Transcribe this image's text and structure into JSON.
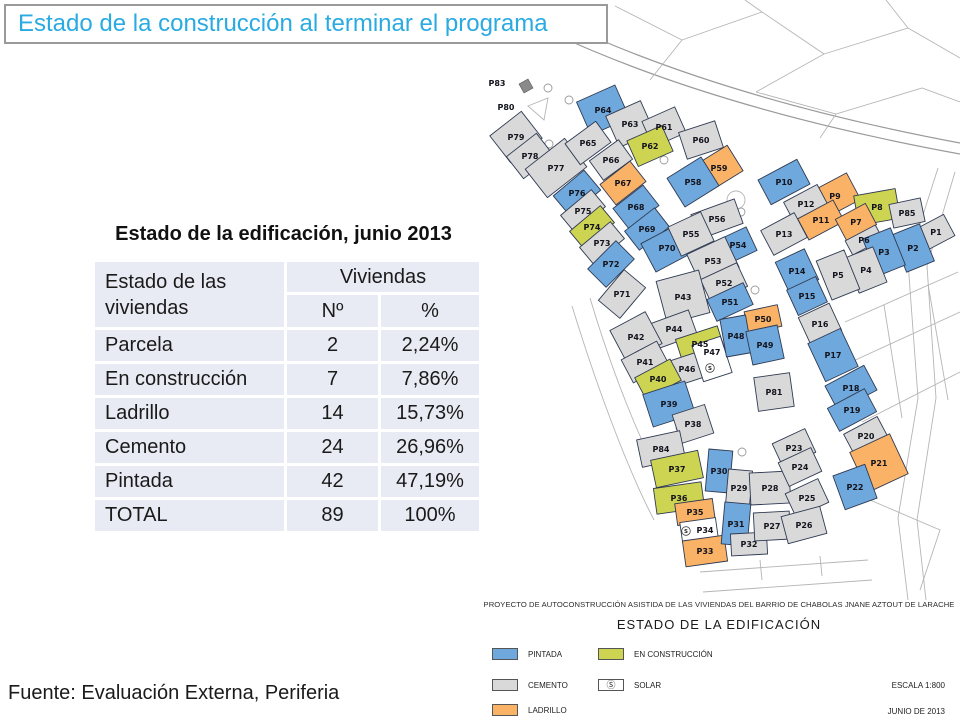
{
  "title": {
    "text": "Estado de la construcción al terminar el programa",
    "color": "#29ABE2"
  },
  "table": {
    "title": "Estado de la edificación, junio 2013",
    "row_header": "Estado de las viviendas",
    "col_group": "Viviendas",
    "columns": [
      "Nº",
      "%"
    ],
    "rows": [
      {
        "label": "Parcela",
        "n": "2",
        "pct": "2,24%"
      },
      {
        "label": "En construcción",
        "n": "7",
        "pct": "7,86%"
      },
      {
        "label": "Ladrillo",
        "n": "14",
        "pct": "15,73%"
      },
      {
        "label": "Cemento",
        "n": "24",
        "pct": "26,96%"
      },
      {
        "label": "Pintada",
        "n": "42",
        "pct": "47,19%"
      },
      {
        "label": "TOTAL",
        "n": "89",
        "pct": "100%"
      }
    ]
  },
  "map": {
    "caption_line1": "PROYECTO DE AUTOCONSTRUCCIÓN ASISTIDA DE LAS VIVIENDAS DEL BARRIO DE CHABOLAS JNANE AZTOUT DE LARACHE",
    "caption_line2": "ESTADO DE LA EDIFICACIÓN",
    "scale": "ESCALA 1:800",
    "date": "JUNIO DE 2013",
    "solar_symbol": "S",
    "status_colors": {
      "pintada": "#6FA8DC",
      "cemento": "#D9D9D9",
      "ladrillo": "#F9B266",
      "construccion": "#CDD452",
      "solar": "#FFFFFF"
    },
    "legend": [
      {
        "label": "PINTADA",
        "status": "pintada"
      },
      {
        "label": "CEMENTO",
        "status": "cemento"
      },
      {
        "label": "LADRILLO",
        "status": "ladrillo"
      },
      {
        "label": "EN CONSTRUCCIÓN",
        "status": "construccion"
      },
      {
        "label": "SOLAR",
        "status": "solar"
      }
    ],
    "floating_labels": [
      {
        "text": "P83",
        "x": 497,
        "y": 86
      },
      {
        "text": "P80",
        "x": 506,
        "y": 110
      }
    ],
    "solar_marks": [
      {
        "x": 710,
        "y": 368
      },
      {
        "x": 686,
        "y": 531
      }
    ],
    "parcels": [
      {
        "id": "P79",
        "s": "cemento",
        "x": 516,
        "y": 137,
        "w": 40,
        "h": 34,
        "a": -38
      },
      {
        "id": "P78",
        "s": "cemento",
        "x": 530,
        "y": 156,
        "w": 38,
        "h": 28,
        "a": -38
      },
      {
        "id": "P77",
        "s": "cemento",
        "x": 556,
        "y": 168,
        "w": 50,
        "h": 36,
        "a": -38
      },
      {
        "id": "P76",
        "s": "pintada",
        "x": 577,
        "y": 193,
        "w": 40,
        "h": 26,
        "a": -40
      },
      {
        "id": "P75",
        "s": "cemento",
        "x": 583,
        "y": 211,
        "w": 40,
        "h": 22,
        "a": -40
      },
      {
        "id": "P74",
        "s": "construccion",
        "x": 592,
        "y": 227,
        "w": 40,
        "h": 22,
        "a": -40
      },
      {
        "id": "P73",
        "s": "cemento",
        "x": 602,
        "y": 243,
        "w": 40,
        "h": 22,
        "a": -40
      },
      {
        "id": "P72",
        "s": "pintada",
        "x": 611,
        "y": 264,
        "w": 40,
        "h": 26,
        "a": -45
      },
      {
        "id": "P71",
        "s": "cemento",
        "x": 622,
        "y": 294,
        "w": 40,
        "h": 28,
        "a": -50
      },
      {
        "id": "P64",
        "s": "pintada",
        "x": 603,
        "y": 110,
        "w": 42,
        "h": 36,
        "a": -24
      },
      {
        "id": "P63",
        "s": "cemento",
        "x": 630,
        "y": 124,
        "w": 38,
        "h": 34,
        "a": -24
      },
      {
        "id": "P61",
        "s": "cemento",
        "x": 664,
        "y": 127,
        "w": 36,
        "h": 28,
        "a": -24
      },
      {
        "id": "P62",
        "s": "construccion",
        "x": 650,
        "y": 146,
        "w": 38,
        "h": 28,
        "a": -24
      },
      {
        "id": "P65",
        "s": "cemento",
        "x": 588,
        "y": 143,
        "w": 38,
        "h": 26,
        "a": -36
      },
      {
        "id": "P66",
        "s": "cemento",
        "x": 611,
        "y": 160,
        "w": 36,
        "h": 24,
        "a": -36
      },
      {
        "id": "P67",
        "s": "ladrillo",
        "x": 623,
        "y": 183,
        "w": 38,
        "h": 26,
        "a": -38
      },
      {
        "id": "P68",
        "s": "pintada",
        "x": 636,
        "y": 207,
        "w": 38,
        "h": 26,
        "a": -38
      },
      {
        "id": "P69",
        "s": "pintada",
        "x": 647,
        "y": 229,
        "w": 38,
        "h": 24,
        "a": -38
      },
      {
        "id": "P70",
        "s": "pintada",
        "x": 667,
        "y": 248,
        "w": 42,
        "h": 32,
        "a": -28
      },
      {
        "id": "P60",
        "s": "cemento",
        "x": 701,
        "y": 140,
        "w": 38,
        "h": 28,
        "a": -18
      },
      {
        "id": "P59",
        "s": "ladrillo",
        "x": 719,
        "y": 168,
        "w": 38,
        "h": 30,
        "a": -32
      },
      {
        "id": "P58",
        "s": "pintada",
        "x": 693,
        "y": 182,
        "w": 40,
        "h": 34,
        "a": -32
      },
      {
        "id": "P10",
        "s": "pintada",
        "x": 784,
        "y": 182,
        "w": 44,
        "h": 28,
        "a": -28
      },
      {
        "id": "P9",
        "s": "ladrillo",
        "x": 835,
        "y": 196,
        "w": 42,
        "h": 30,
        "a": -28
      },
      {
        "id": "P12",
        "s": "cemento",
        "x": 806,
        "y": 204,
        "w": 38,
        "h": 24,
        "a": -28
      },
      {
        "id": "P11",
        "s": "ladrillo",
        "x": 821,
        "y": 220,
        "w": 40,
        "h": 24,
        "a": -28
      },
      {
        "id": "P8",
        "s": "construccion",
        "x": 877,
        "y": 207,
        "w": 42,
        "h": 30,
        "a": -10
      },
      {
        "id": "P85",
        "s": "cemento",
        "x": 907,
        "y": 213,
        "w": 32,
        "h": 24,
        "a": -12
      },
      {
        "id": "P7",
        "s": "ladrillo",
        "x": 856,
        "y": 222,
        "w": 34,
        "h": 24,
        "a": -28
      },
      {
        "id": "P6",
        "s": "cemento",
        "x": 864,
        "y": 240,
        "w": 34,
        "h": 16,
        "a": -28
      },
      {
        "id": "P13",
        "s": "cemento",
        "x": 784,
        "y": 234,
        "w": 38,
        "h": 28,
        "a": -28
      },
      {
        "id": "P1",
        "s": "cemento",
        "x": 936,
        "y": 232,
        "w": 30,
        "h": 24,
        "a": -28
      },
      {
        "id": "P2",
        "s": "pintada",
        "x": 913,
        "y": 248,
        "w": 30,
        "h": 40,
        "a": -22
      },
      {
        "id": "P3",
        "s": "pintada",
        "x": 884,
        "y": 252,
        "w": 30,
        "h": 40,
        "a": -22
      },
      {
        "id": "P4",
        "s": "cemento",
        "x": 866,
        "y": 270,
        "w": 30,
        "h": 38,
        "a": -22
      },
      {
        "id": "P5",
        "s": "cemento",
        "x": 838,
        "y": 275,
        "w": 30,
        "h": 42,
        "a": -22
      },
      {
        "id": "P56",
        "s": "cemento",
        "x": 717,
        "y": 219,
        "w": 46,
        "h": 26,
        "a": -20
      },
      {
        "id": "P55",
        "s": "cemento",
        "x": 691,
        "y": 234,
        "w": 36,
        "h": 32,
        "a": -25
      },
      {
        "id": "P54",
        "s": "pintada",
        "x": 738,
        "y": 245,
        "w": 30,
        "h": 26,
        "a": -25
      },
      {
        "id": "P53",
        "s": "cemento",
        "x": 713,
        "y": 261,
        "w": 42,
        "h": 34,
        "a": -25
      },
      {
        "id": "P52",
        "s": "cemento",
        "x": 724,
        "y": 283,
        "w": 40,
        "h": 26,
        "a": -25
      },
      {
        "id": "P51",
        "s": "pintada",
        "x": 730,
        "y": 302,
        "w": 40,
        "h": 24,
        "a": -25
      },
      {
        "id": "P14",
        "s": "pintada",
        "x": 797,
        "y": 271,
        "w": 32,
        "h": 34,
        "a": -25
      },
      {
        "id": "P15",
        "s": "pintada",
        "x": 807,
        "y": 296,
        "w": 32,
        "h": 28,
        "a": -25
      },
      {
        "id": "P16",
        "s": "cemento",
        "x": 820,
        "y": 324,
        "w": 34,
        "h": 30,
        "a": -25
      },
      {
        "id": "P17",
        "s": "pintada",
        "x": 833,
        "y": 355,
        "w": 36,
        "h": 42,
        "a": -25
      },
      {
        "id": "P18",
        "s": "pintada",
        "x": 851,
        "y": 388,
        "w": 44,
        "h": 28,
        "a": -28
      },
      {
        "id": "P19",
        "s": "pintada",
        "x": 852,
        "y": 410,
        "w": 42,
        "h": 26,
        "a": -28
      },
      {
        "id": "P20",
        "s": "cemento",
        "x": 866,
        "y": 436,
        "w": 38,
        "h": 24,
        "a": -28
      },
      {
        "id": "P21",
        "s": "ladrillo",
        "x": 879,
        "y": 463,
        "w": 44,
        "h": 44,
        "a": -25
      },
      {
        "id": "P22",
        "s": "pintada",
        "x": 855,
        "y": 487,
        "w": 34,
        "h": 36,
        "a": -20
      },
      {
        "id": "P43",
        "s": "cemento",
        "x": 683,
        "y": 297,
        "w": 44,
        "h": 44,
        "a": -15
      },
      {
        "id": "P44",
        "s": "cemento",
        "x": 674,
        "y": 329,
        "w": 40,
        "h": 26,
        "a": -20
      },
      {
        "id": "P45",
        "s": "construccion",
        "x": 700,
        "y": 344,
        "w": 44,
        "h": 24,
        "a": -18
      },
      {
        "id": "P46",
        "s": "cemento",
        "x": 687,
        "y": 369,
        "w": 36,
        "h": 26,
        "a": -18
      },
      {
        "id": "P47",
        "s": "solar",
        "x": 712,
        "y": 359,
        "w": 30,
        "h": 38,
        "a": -18,
        "ly": -7
      },
      {
        "id": "P42",
        "s": "cemento",
        "x": 636,
        "y": 337,
        "w": 40,
        "h": 36,
        "a": -28
      },
      {
        "id": "P41",
        "s": "cemento",
        "x": 645,
        "y": 362,
        "w": 40,
        "h": 26,
        "a": -28
      },
      {
        "id": "P40",
        "s": "construccion",
        "x": 658,
        "y": 379,
        "w": 40,
        "h": 24,
        "a": -28
      },
      {
        "id": "P50",
        "s": "ladrillo",
        "x": 763,
        "y": 319,
        "w": 34,
        "h": 22,
        "a": -12
      },
      {
        "id": "P48",
        "s": "pintada",
        "x": 736,
        "y": 336,
        "w": 26,
        "h": 38,
        "a": -10
      },
      {
        "id": "P49",
        "s": "pintada",
        "x": 765,
        "y": 345,
        "w": 32,
        "h": 34,
        "a": -12
      },
      {
        "id": "P81",
        "s": "cemento",
        "x": 774,
        "y": 392,
        "w": 36,
        "h": 34,
        "a": -8
      },
      {
        "id": "P39",
        "s": "pintada",
        "x": 669,
        "y": 404,
        "w": 44,
        "h": 34,
        "a": -18
      },
      {
        "id": "P38",
        "s": "cemento",
        "x": 693,
        "y": 424,
        "w": 34,
        "h": 30,
        "a": -18
      },
      {
        "id": "P84",
        "s": "cemento",
        "x": 661,
        "y": 449,
        "w": 44,
        "h": 28,
        "a": -12
      },
      {
        "id": "P37",
        "s": "construccion",
        "x": 677,
        "y": 469,
        "w": 48,
        "h": 28,
        "a": -12
      },
      {
        "id": "P36",
        "s": "construccion",
        "x": 679,
        "y": 498,
        "w": 48,
        "h": 26,
        "a": -8
      },
      {
        "id": "P35",
        "s": "ladrillo",
        "x": 695,
        "y": 512,
        "w": 38,
        "h": 22,
        "a": -8
      },
      {
        "id": "P34",
        "s": "solar",
        "x": 699,
        "y": 530,
        "w": 36,
        "h": 20,
        "a": -8,
        "lx": 6
      },
      {
        "id": "P33",
        "s": "ladrillo",
        "x": 705,
        "y": 551,
        "w": 42,
        "h": 26,
        "a": -8
      },
      {
        "id": "P30",
        "s": "pintada",
        "x": 719,
        "y": 471,
        "w": 24,
        "h": 42,
        "a": 5
      },
      {
        "id": "P29",
        "s": "cemento",
        "x": 739,
        "y": 488,
        "w": 24,
        "h": 36,
        "a": 5
      },
      {
        "id": "P28",
        "s": "cemento",
        "x": 770,
        "y": 488,
        "w": 40,
        "h": 32,
        "a": -3
      },
      {
        "id": "P31",
        "s": "pintada",
        "x": 736,
        "y": 524,
        "w": 26,
        "h": 42,
        "a": 5
      },
      {
        "id": "P32",
        "s": "cemento",
        "x": 749,
        "y": 544,
        "w": 36,
        "h": 22,
        "a": -3
      },
      {
        "id": "P27",
        "s": "cemento",
        "x": 772,
        "y": 526,
        "w": 36,
        "h": 28,
        "a": -3
      },
      {
        "id": "P23",
        "s": "cemento",
        "x": 794,
        "y": 448,
        "w": 36,
        "h": 26,
        "a": -25
      },
      {
        "id": "P24",
        "s": "cemento",
        "x": 800,
        "y": 467,
        "w": 36,
        "h": 26,
        "a": -25
      },
      {
        "id": "P25",
        "s": "cemento",
        "x": 807,
        "y": 498,
        "w": 36,
        "h": 26,
        "a": -25
      },
      {
        "id": "P26",
        "s": "cemento",
        "x": 804,
        "y": 525,
        "w": 40,
        "h": 28,
        "a": -15
      }
    ]
  },
  "footer": {
    "source": "Fuente: Evaluación Externa, Periferia"
  }
}
